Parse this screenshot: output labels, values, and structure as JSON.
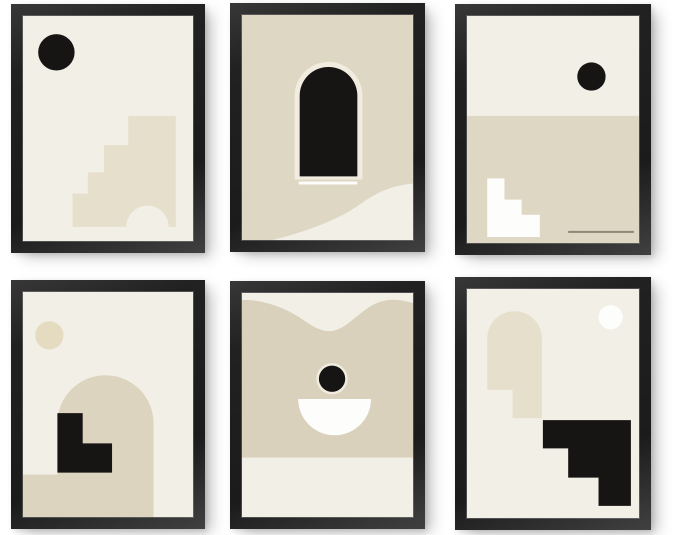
{
  "page": {
    "background": "#ffffff"
  },
  "colors": {
    "frame": "#212121",
    "cream": "#f2efe7",
    "halo": "#f1ecdf",
    "beige": "#ded7c3",
    "beige_light": "#e6dfcc",
    "beige_mid": "#dcd4bf",
    "beige_deep": "#d9d1bb",
    "tan": "#e4dbc1",
    "ink": "#171513",
    "white": "#fdfdfb",
    "line": "#8e8878"
  },
  "prints": [
    {
      "id": "top-left",
      "shapes": [
        "black-sun-circle",
        "beige-staircase-with-arch-cutout"
      ]
    },
    {
      "id": "top-center",
      "shapes": [
        "cream-halo",
        "black-arched-door",
        "white-underline",
        "cream-dune-wave"
      ]
    },
    {
      "id": "top-right",
      "shapes": [
        "black-sun-circle",
        "beige-horizon-field",
        "white-staircase",
        "thin-horizontal-line"
      ]
    },
    {
      "id": "bottom-left",
      "shapes": [
        "beige-sun-circle",
        "beige-arch",
        "beige-ground-band",
        "black-corner-steps"
      ]
    },
    {
      "id": "bottom-center",
      "shapes": [
        "beige-wave-field",
        "black-circle-with-halo",
        "white-bowl-semicircle"
      ]
    },
    {
      "id": "bottom-right",
      "shapes": [
        "white-moon-circle",
        "beige-stepped-arch",
        "black-staircase-block"
      ]
    }
  ]
}
